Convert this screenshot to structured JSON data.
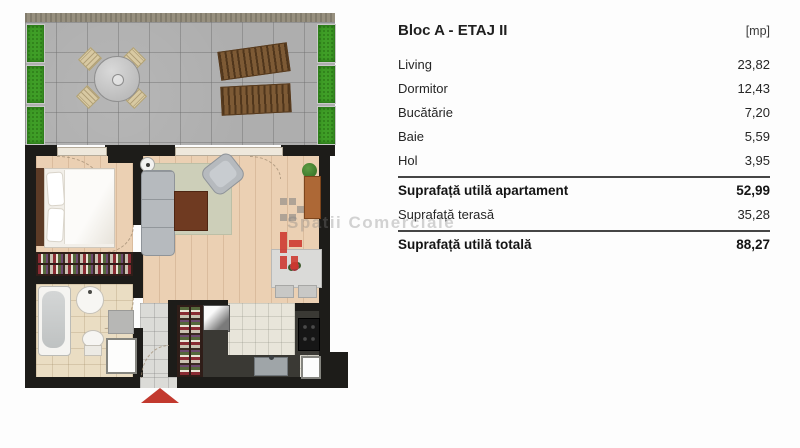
{
  "panel": {
    "title": "Bloc A - ETAJ II",
    "unit_header": "[mp]",
    "rooms": [
      {
        "label": "Living",
        "value": "23,82"
      },
      {
        "label": "Dormitor",
        "value": "12,43"
      },
      {
        "label": "Bucătărie",
        "value": "7,20"
      },
      {
        "label": "Baie",
        "value": "5,59"
      },
      {
        "label": "Hol",
        "value": "3,95"
      }
    ],
    "summary": [
      {
        "label": "Suprafață utilă apartament",
        "value": "52,99"
      },
      {
        "label": "Suprafață terasă",
        "value": "35,28"
      },
      {
        "label": "Suprafață utilă totală",
        "value": "88,27"
      }
    ]
  },
  "watermark": {
    "text": "Spatii Comerciale"
  },
  "floorplan": {
    "icons": [
      "terrace-tiles",
      "planter",
      "round-table",
      "terrace-chair",
      "sun-lounger",
      "bed",
      "pillow",
      "wardrobe",
      "bathtub",
      "washbasin",
      "toilet",
      "bath-mat",
      "bath-cabinet",
      "sofa",
      "rug",
      "coffee-table",
      "armchair",
      "plant",
      "sideboard",
      "dining-table",
      "dining-chair",
      "flower-centerpiece",
      "pantry-wardrobe",
      "fridge",
      "kitchen-counter",
      "stove",
      "kitchen-sink",
      "kitchen-cabinet",
      "door-swing-arc",
      "entrance-arrow"
    ],
    "colors": {
      "wall": "#1d1c19",
      "wood_floor": "#ebd0b3",
      "terrace_tile": "#aeaeae",
      "planter_green": "#3f9e27",
      "entrance_arrow_red": "#c2392e",
      "counter_charcoal": "#3a3934"
    }
  }
}
